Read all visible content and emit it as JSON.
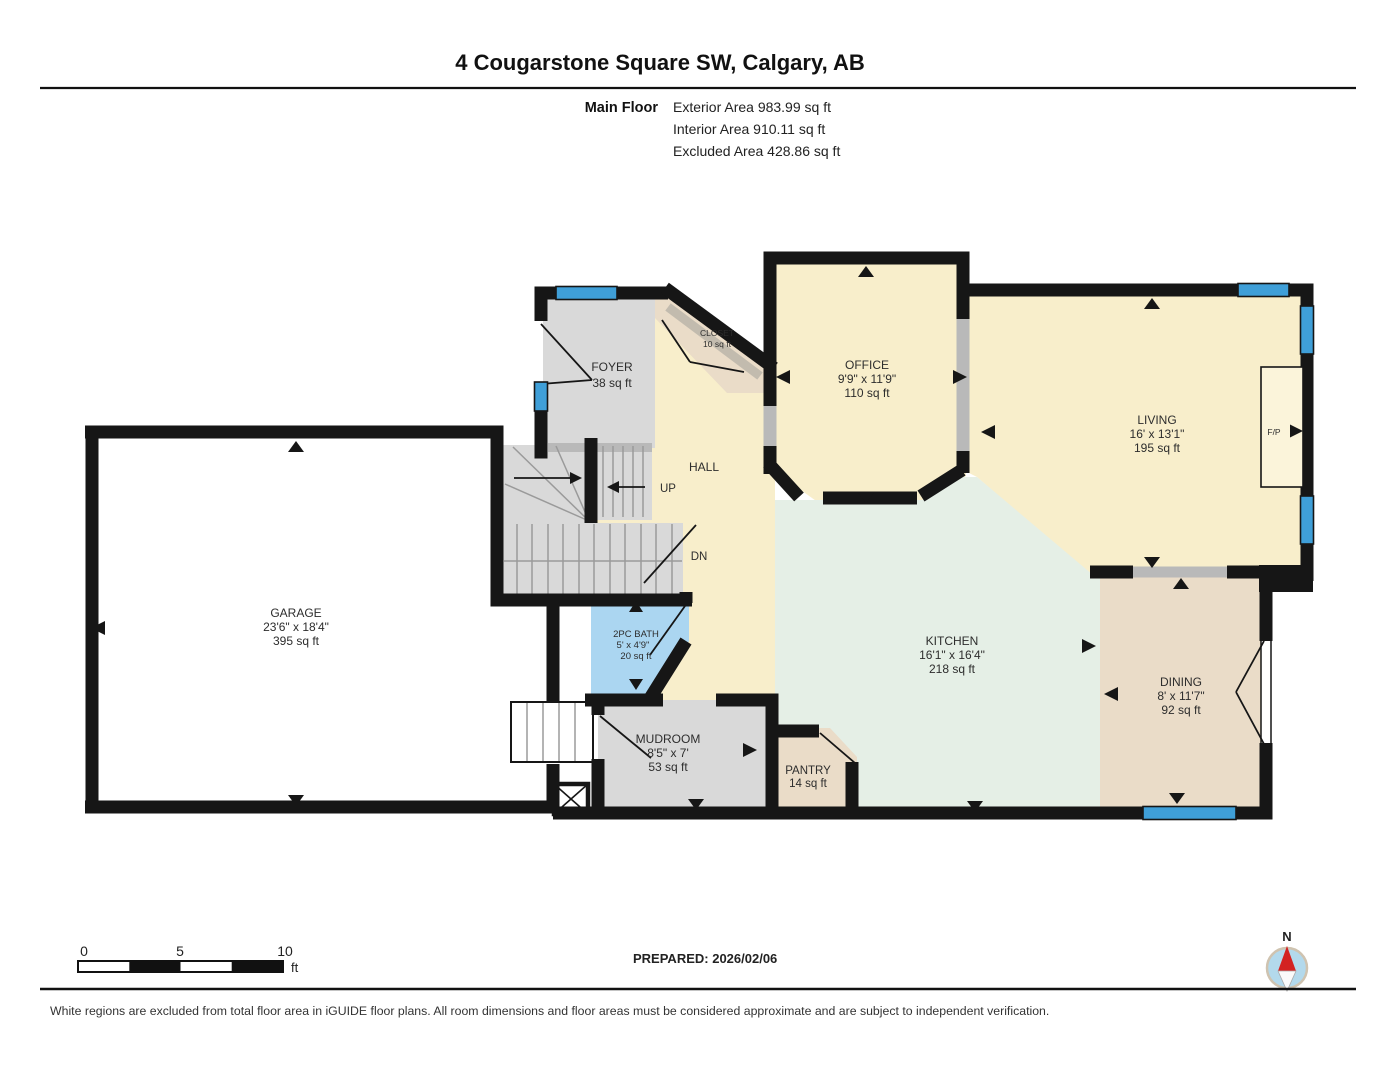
{
  "header": {
    "title": "4 Cougarstone Square SW, Calgary, AB",
    "floor_label": "Main Floor",
    "stats": {
      "exterior": "Exterior Area 983.99 sq ft",
      "interior": "Interior Area 910.11 sq ft",
      "excluded": "Excluded Area 428.86 sq ft"
    }
  },
  "rooms": {
    "garage": {
      "name": "GARAGE",
      "dims": "23'6\" x 18'4\"",
      "area": "395 sq ft"
    },
    "foyer": {
      "name": "FOYER",
      "area": "38 sq ft"
    },
    "closet": {
      "name": "CLOSET",
      "area": "10 sq ft"
    },
    "hall": {
      "name": "HALL"
    },
    "office": {
      "name": "OFFICE",
      "dims": "9'9\" x 11'9\"",
      "area": "110 sq ft"
    },
    "living": {
      "name": "LIVING",
      "dims": "16' x 13'1\"",
      "area": "195 sq ft"
    },
    "kitchen": {
      "name": "KITCHEN",
      "dims": "16'1\" x 16'4\"",
      "area": "218 sq ft"
    },
    "dining": {
      "name": "DINING",
      "dims": "8' x 11'7\"",
      "area": "92 sq ft"
    },
    "bath": {
      "name": "2PC BATH",
      "dims": "5' x 4'9\"",
      "area": "20 sq ft"
    },
    "mudroom": {
      "name": "MUDROOM",
      "dims": "8'5\" x 7'",
      "area": "53 sq ft"
    },
    "pantry": {
      "name": "PANTRY",
      "area": "14 sq ft"
    }
  },
  "annotations": {
    "up": "UP",
    "down": "DN",
    "fireplace": "F/P",
    "north": "N"
  },
  "scale_bar": {
    "tick0": "0",
    "tick5": "5",
    "tick10": "10",
    "unit": "ft"
  },
  "footer": {
    "prepared": "PREPARED: 2026/02/06",
    "disclaimer": "White regions are excluded from total floor area in iGUIDE floor plans. All room dimensions and floor areas must be considered approximate and are subject to independent verification."
  },
  "colors": {
    "wall_color": "#161616",
    "room_cream": "#f8eecb",
    "room_mint": "#e5efe6",
    "room_tan": "#eadcc8",
    "room_gray": "#d9d9d9",
    "room_bath_blue": "#abd6f1",
    "window_blue": "#3f9fd8",
    "opening_gray": "#b9b9b9",
    "compass_blue": "#b3d9ec",
    "compass_red": "#d32222"
  }
}
